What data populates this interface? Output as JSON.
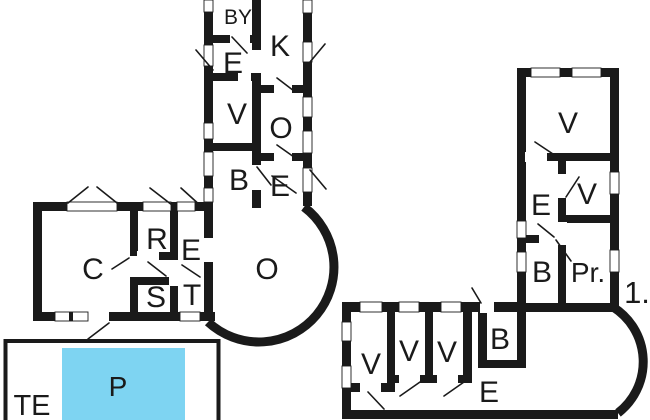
{
  "title": "Floor plan drawing",
  "colors": {
    "wall": "#1a1a1a",
    "background": "#ffffff",
    "pool_fill": "#7ed4f2",
    "label_text": "#1a1a1a"
  },
  "ground_floor": {
    "top_wing_rooms": [
      {
        "id": "by",
        "label": "BY"
      },
      {
        "id": "k",
        "label": "K"
      },
      {
        "id": "e1",
        "label": "E"
      },
      {
        "id": "v1",
        "label": "V"
      },
      {
        "id": "o1",
        "label": "O"
      },
      {
        "id": "b1",
        "label": "B"
      },
      {
        "id": "e2",
        "label": "E"
      }
    ],
    "main_block_rooms": [
      {
        "id": "c",
        "label": "C"
      },
      {
        "id": "r",
        "label": "R"
      },
      {
        "id": "e3",
        "label": "E"
      },
      {
        "id": "s",
        "label": "S"
      },
      {
        "id": "t",
        "label": "T"
      },
      {
        "id": "o2",
        "label": "O"
      }
    ]
  },
  "upper_floor": {
    "floor_label": "1.",
    "right_wing_rooms": [
      {
        "id": "uv1",
        "label": "V"
      },
      {
        "id": "ue1",
        "label": "E"
      },
      {
        "id": "uv2",
        "label": "V"
      },
      {
        "id": "ub1",
        "label": "B"
      },
      {
        "id": "upr",
        "label": "Pr."
      }
    ],
    "bottom_wing_rooms": [
      {
        "id": "uv3",
        "label": "V"
      },
      {
        "id": "uv4",
        "label": "V"
      },
      {
        "id": "uv5",
        "label": "V"
      },
      {
        "id": "ub2",
        "label": "B"
      },
      {
        "id": "ue2",
        "label": "E"
      }
    ]
  },
  "terrace": {
    "label": "TE",
    "pool_label": "P"
  }
}
